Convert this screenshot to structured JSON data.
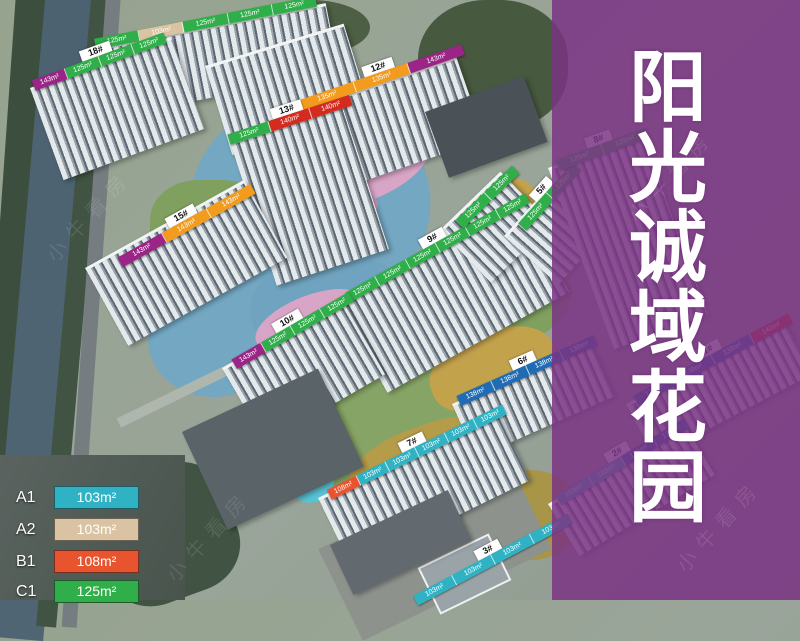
{
  "page": {
    "title_vertical": "阳光诚域花园",
    "watermark": "小牛看房"
  },
  "palette": {
    "purple": "#9b2586",
    "green": "#2fae4a",
    "amber": "#f29b1d",
    "red": "#d42b1e",
    "teal": "#2fb3c4",
    "tan": "#d9c3a2",
    "orangered": "#e8542d",
    "blue": "#1f6cb5"
  },
  "legend": {
    "items": [
      {
        "label": "A1",
        "value": "103m²",
        "color": "teal"
      },
      {
        "label": "A2",
        "value": "103m²",
        "color": "tan"
      },
      {
        "label": "B1",
        "value": "108m²",
        "color": "orangered"
      },
      {
        "label": "C1",
        "value": "125m²",
        "color": "green"
      }
    ]
  },
  "buildings": [
    {
      "number": "",
      "units": [
        {
          "size": "125m²",
          "type": "green"
        },
        {
          "size": "103m²",
          "type": "tan"
        },
        {
          "size": "125m²",
          "type": "green"
        },
        {
          "size": "125m²",
          "type": "green"
        },
        {
          "size": "125m²",
          "type": "green"
        }
      ]
    },
    {
      "number": "18#",
      "units": [
        {
          "size": "143m²",
          "type": "purple"
        },
        {
          "size": "125m²",
          "type": "green"
        },
        {
          "size": "125m²",
          "type": "green"
        },
        {
          "size": "125m²",
          "type": "green"
        }
      ]
    },
    {
      "number": "12#",
      "units": [
        {
          "size": "135m²",
          "type": "amber"
        },
        {
          "size": "135m²",
          "type": "amber"
        },
        {
          "size": "143m²",
          "type": "purple"
        }
      ]
    },
    {
      "number": "13#",
      "units": [
        {
          "size": "125m²",
          "type": "green"
        },
        {
          "size": "140m²",
          "type": "red"
        },
        {
          "size": "140m²",
          "type": "red"
        }
      ]
    },
    {
      "number": "15#",
      "units": [
        {
          "size": "143m²",
          "type": "purple"
        },
        {
          "size": "143m²",
          "type": "amber"
        },
        {
          "size": "143m²",
          "type": "amber"
        }
      ]
    },
    {
      "number": "9#",
      "units": [
        {
          "size": "125m²",
          "type": "green"
        },
        {
          "size": "125m²",
          "type": "green"
        },
        {
          "size": "125m²",
          "type": "green"
        },
        {
          "size": "125m²",
          "type": "green"
        },
        {
          "size": "125m²",
          "type": "green"
        },
        {
          "size": "125m²",
          "type": "green"
        }
      ]
    },
    {
      "number": "10#",
      "units": [
        {
          "size": "143m²",
          "type": "purple"
        },
        {
          "size": "125m²",
          "type": "green"
        },
        {
          "size": "125m²",
          "type": "green"
        },
        {
          "size": "125m²",
          "type": "green"
        }
      ]
    },
    {
      "number": "",
      "units": [
        {
          "size": "125m²",
          "type": "green"
        },
        {
          "size": "125m²",
          "type": "green"
        }
      ]
    },
    {
      "number": "5#",
      "units": [
        {
          "size": "125m²",
          "type": "green"
        },
        {
          "size": "125m²",
          "type": "green"
        }
      ]
    },
    {
      "number": "6#",
      "units": [
        {
          "size": "138m²",
          "type": "blue"
        },
        {
          "size": "138m²",
          "type": "blue"
        },
        {
          "size": "138m²",
          "type": "blue"
        },
        {
          "size": "138m²",
          "type": "blue"
        }
      ]
    },
    {
      "number": "7#",
      "units": [
        {
          "size": "108m²",
          "type": "orangered"
        },
        {
          "size": "103m²",
          "type": "teal"
        },
        {
          "size": "103m²",
          "type": "teal"
        },
        {
          "size": "103m²",
          "type": "teal"
        },
        {
          "size": "103m²",
          "type": "teal"
        },
        {
          "size": "103m²",
          "type": "teal"
        }
      ]
    },
    {
      "number": "3#",
      "units": [
        {
          "size": "103m²",
          "type": "teal"
        },
        {
          "size": "103m²",
          "type": "teal"
        },
        {
          "size": "103m²",
          "type": "teal"
        },
        {
          "size": "103m²",
          "type": "teal"
        }
      ]
    },
    {
      "number": "8#",
      "units": [
        {
          "size": "125m²",
          "type": "green"
        },
        {
          "size": "125m²",
          "type": "green"
        }
      ]
    },
    {
      "number": "1#",
      "units": [
        {
          "size": "138m²",
          "type": "blue"
        },
        {
          "size": "138m²",
          "type": "blue"
        },
        {
          "size": "138m²",
          "type": "blue"
        },
        {
          "size": "140m²",
          "type": "red"
        }
      ]
    },
    {
      "number": "2#",
      "units": [
        {
          "size": "103m²",
          "type": "teal"
        },
        {
          "size": "103m²",
          "type": "teal"
        },
        {
          "size": "138m²",
          "type": "blue"
        },
        {
          "size": "138m²",
          "type": "blue"
        }
      ]
    }
  ]
}
